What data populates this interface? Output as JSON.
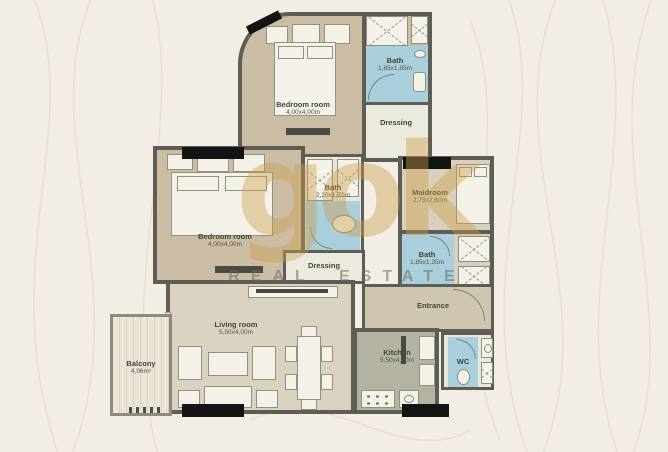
{
  "watermark": {
    "logo_text": "gok",
    "tagline": "REAL ESTATE"
  },
  "rooms": {
    "bedroom_top": {
      "name": "Bedroom room",
      "dims": "4,00x4,00m"
    },
    "bath_top": {
      "name": "Bath",
      "dims": "1,85x1,85m"
    },
    "dressing_top": {
      "name": "Dressing"
    },
    "bedroom_mid": {
      "name": "Bedroom room",
      "dims": "4,00x4,00m"
    },
    "bath_mid": {
      "name": "Bath",
      "dims": "2,20x1,70m"
    },
    "dressing_mid": {
      "name": "Dressing"
    },
    "maidroom": {
      "name": "Maidroom",
      "dims": "2,75x2,60m"
    },
    "bath_maid": {
      "name": "Bath",
      "dims": "1,85x1,35m"
    },
    "entrance": {
      "name": "Entrance"
    },
    "living_room": {
      "name": "Living room",
      "dims": "5,50x4,00m"
    },
    "balcony": {
      "name": "Balcony",
      "dims": "4,96m²"
    },
    "kitchen": {
      "name": "Kitchen",
      "dims": "5,50x4,00m"
    },
    "wc": {
      "name": "WC"
    }
  },
  "colors": {
    "background": "#f2eee5",
    "floor_tan": "#cabda4",
    "floor_light": "#dad2c0",
    "bath_blue": "#a9cedc",
    "wall": "#5d5d55",
    "window_black": "#141414",
    "watermark_gold": "#cc9e4a"
  }
}
